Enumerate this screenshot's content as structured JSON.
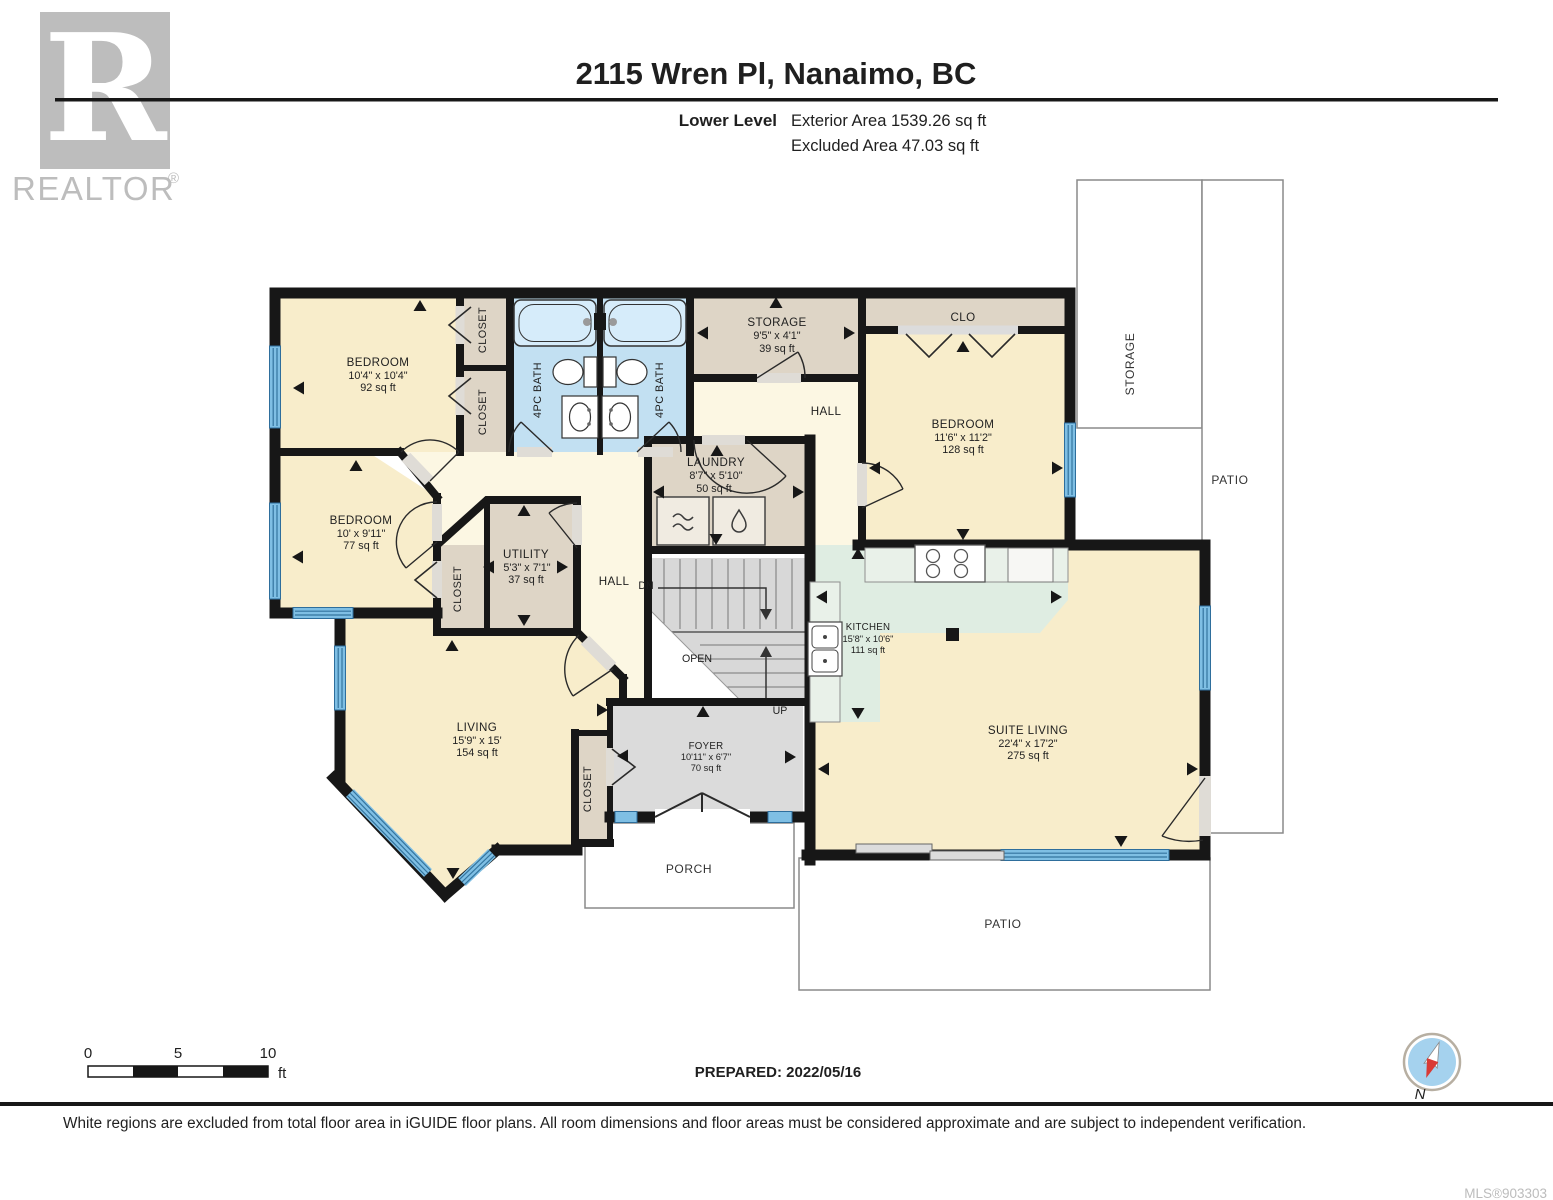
{
  "header": {
    "logo_r": "R",
    "logo_brand": "REALTOR",
    "logo_reg": "®",
    "title": "2115 Wren Pl, Nanaimo, BC",
    "level": "Lower Level",
    "exterior_area": "Exterior Area 1539.26 sq ft",
    "excluded_area": "Excluded Area 47.03 sq ft"
  },
  "plan": {
    "rooms": {
      "bedroom1": {
        "name": "BEDROOM",
        "dims": "10'4\" x 10'4\"",
        "area": "92 sq ft"
      },
      "bedroom2": {
        "name": "BEDROOM",
        "dims": "10' x 9'11\"",
        "area": "77 sq ft"
      },
      "bedroom3": {
        "name": "BEDROOM",
        "dims": "11'6\" x 11'2\"",
        "area": "128 sq ft"
      },
      "bath1": {
        "name": "4PC BATH"
      },
      "bath2": {
        "name": "4PC BATH"
      },
      "storage": {
        "name": "STORAGE",
        "dims": "9'5\" x 4'1\"",
        "area": "39 sq ft"
      },
      "laundry": {
        "name": "LAUNDRY",
        "dims": "8'7\" x 5'10\"",
        "area": "50 sq ft"
      },
      "utility": {
        "name": "UTILITY",
        "dims": "5'3\" x 7'1\"",
        "area": "37 sq ft"
      },
      "kitchen": {
        "name": "KITCHEN",
        "dims": "15'8\" x 10'6\"",
        "area": "111 sq ft"
      },
      "living": {
        "name": "LIVING",
        "dims": "15'9\" x 15'",
        "area": "154 sq ft"
      },
      "suite_living": {
        "name": "SUITE LIVING",
        "dims": "22'4\" x 17'2\"",
        "area": "275 sq ft"
      },
      "foyer": {
        "name": "FOYER",
        "dims": "10'11\" x 6'7\"",
        "area": "70 sq ft"
      }
    },
    "labels": {
      "clo": "CLO",
      "closet": "CLOSET",
      "hall": "HALL",
      "dn": "DN",
      "up": "UP",
      "open": "OPEN",
      "porch": "PORCH",
      "patio": "PATIO",
      "storage_outdoor": "STORAGE"
    }
  },
  "footer": {
    "scale_0": "0",
    "scale_5": "5",
    "scale_10": "10",
    "scale_unit": "ft",
    "prepared": "PREPARED: 2022/05/16",
    "north": "N",
    "disclaimer": "White regions are excluded from total floor area in iGUIDE floor plans. All room dimensions and floor areas must be considered approximate and are subject to independent verification.",
    "mls": "MLS®903303"
  },
  "colors": {
    "wall": "#171717",
    "room_beige": "#F8EDCB",
    "hall_cream": "#FCF7E3",
    "closet_taupe": "#DED5C6",
    "bath_blue": "#C2E0F2",
    "kitchen_mint": "#DFEDE2",
    "foyer_gray": "#DBDBDB",
    "window_blue": "#7FBFE4",
    "compass_red": "#D93A35",
    "logo_gray": "#BDBDBD"
  }
}
